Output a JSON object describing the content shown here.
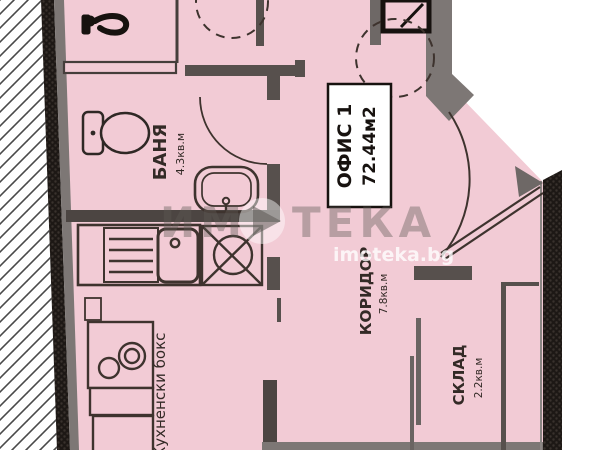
{
  "page": {
    "type": "apartment-floor-plan"
  },
  "rooms": {
    "office": {
      "name": "ОФИС 1",
      "area": "72.44м2"
    },
    "bathroom": {
      "name": "БАНЯ",
      "area": "4.3кв.м"
    },
    "corridor": {
      "name": "КОРИДОР",
      "area": "7.8кв.м"
    },
    "storage": {
      "name": "СКЛАД",
      "area": "2.2кв.м"
    },
    "kitchenette": {
      "name": "Кухненски бокс"
    }
  },
  "watermark": {
    "brand_left": "ИМ",
    "brand_right": "ТЕКА",
    "site": "imoteka.bg"
  },
  "icons": {
    "logo": "imoteka-play-logo",
    "toilet": "toilet-icon",
    "bathroom_sink": "sink-icon",
    "wall_faucet": "faucet-icon",
    "boiler": "dashed-boiler-icon",
    "kitchen_sink": "kitchen-sink-icon",
    "drainboard": "drainboard-icon",
    "stove": "stove-burners-icon",
    "shaft": "x-shaft-icon",
    "window": "window-icon",
    "entrance_door": "door-swing-arc"
  },
  "colors": {
    "floor_pink": "#f2cbd5",
    "wall_gray": "#7d7775",
    "wall_medium": "#5b5350",
    "wall_dark": "#1d1815",
    "line_dark": "#3e332e",
    "label_box": "#ffffff",
    "watermark_gray": "rgba(95,90,86,0.40)",
    "watermark_site": "rgba(255,255,255,0.78)"
  }
}
